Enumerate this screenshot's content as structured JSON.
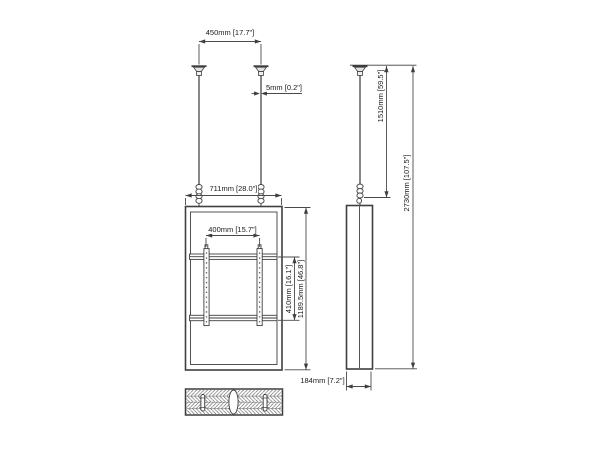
{
  "labels": {
    "pole_spacing": "450mm [17.7\"]",
    "pole_diameter": "5mm [0.2\"]",
    "panel_width": "711mm [28.0\"]",
    "bracket_width": "400mm [15.7\"]",
    "bracket_height": "410mm [16.1\"]",
    "panel_height": "1189.5mm [46.8\"]",
    "drop_height": "1510mm [59.5\"]",
    "total_height": "2730mm [107.5\"]",
    "panel_depth": "184mm [7.2\"]"
  },
  "colors": {
    "line": "#3f3f3f",
    "thin_line": "#4a4a4a",
    "text": "#1a1a1a",
    "background": "#ffffff"
  }
}
